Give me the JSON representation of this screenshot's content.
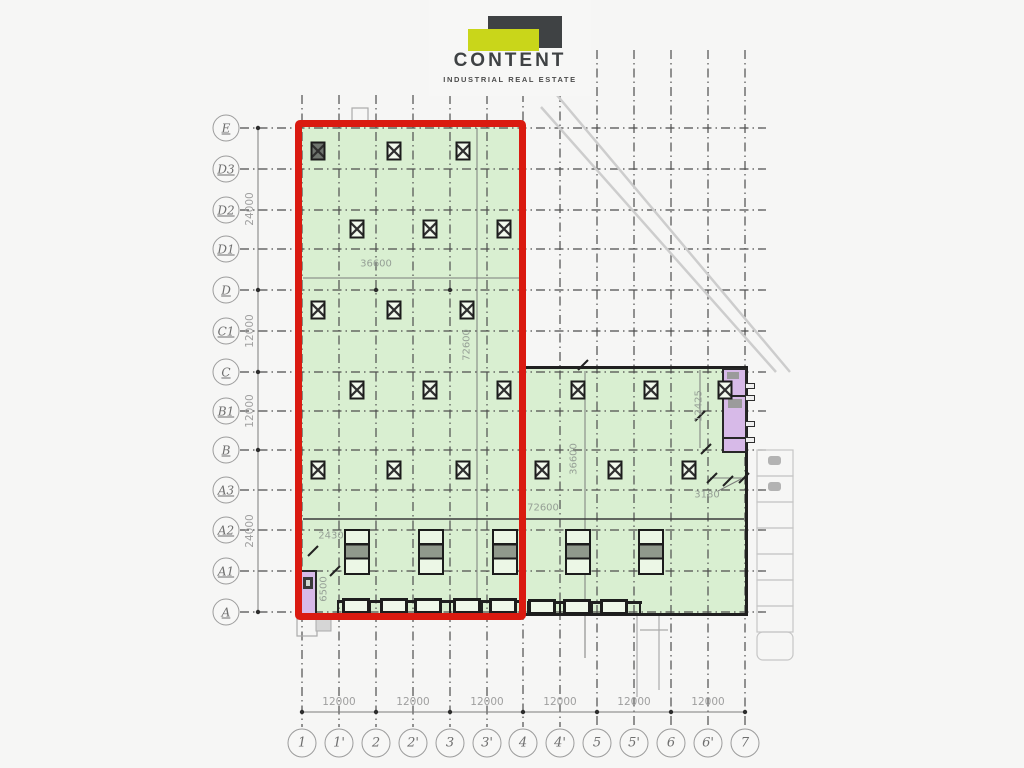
{
  "logo": {
    "title": "CONTENT",
    "subtitle": "INDUSTRIAL REAL ESTATE",
    "brand_dark": "#3f4244",
    "brand_accent": "#c9d61a"
  },
  "colors": {
    "highlight_red": "#da1a10",
    "area_green": "#d9efd1",
    "room_purple": "#d7bae8",
    "grid_line": "#4e4e4e",
    "dimension_text": "#96a096"
  },
  "axes": {
    "left": [
      {
        "label": "E",
        "x": 226,
        "y": 128
      },
      {
        "label": "D3",
        "x": 226,
        "y": 169
      },
      {
        "label": "D2",
        "x": 226,
        "y": 210
      },
      {
        "label": "D1",
        "x": 226,
        "y": 249
      },
      {
        "label": "D",
        "x": 226,
        "y": 290
      },
      {
        "label": "C1",
        "x": 226,
        "y": 331
      },
      {
        "label": "C",
        "x": 226,
        "y": 372
      },
      {
        "label": "B1",
        "x": 226,
        "y": 411
      },
      {
        "label": "B",
        "x": 226,
        "y": 450
      },
      {
        "label": "A3",
        "x": 226,
        "y": 490
      },
      {
        "label": "A2",
        "x": 226,
        "y": 530
      },
      {
        "label": "A1",
        "x": 226,
        "y": 571
      },
      {
        "label": "A",
        "x": 226,
        "y": 612
      }
    ],
    "bottom": [
      {
        "label": "1",
        "x": 302,
        "y": 743
      },
      {
        "label": "1'",
        "x": 339,
        "y": 743
      },
      {
        "label": "2",
        "x": 376,
        "y": 743
      },
      {
        "label": "2'",
        "x": 413,
        "y": 743
      },
      {
        "label": "3",
        "x": 450,
        "y": 743
      },
      {
        "label": "3'",
        "x": 487,
        "y": 743
      },
      {
        "label": "4",
        "x": 523,
        "y": 743
      },
      {
        "label": "4'",
        "x": 560,
        "y": 743
      },
      {
        "label": "5",
        "x": 597,
        "y": 743
      },
      {
        "label": "5'",
        "x": 634,
        "y": 743
      },
      {
        "label": "6",
        "x": 671,
        "y": 743
      },
      {
        "label": "6'",
        "x": 708,
        "y": 743
      },
      {
        "label": "7",
        "x": 745,
        "y": 743
      }
    ]
  },
  "dimensions": {
    "left": [
      {
        "label": "24000",
        "x": 250,
        "y": 209,
        "rot": -90
      },
      {
        "label": "12000",
        "x": 250,
        "y": 331,
        "rot": -90
      },
      {
        "label": "12000",
        "x": 250,
        "y": 411,
        "rot": -90
      },
      {
        "label": "24000",
        "x": 250,
        "y": 531,
        "rot": -90
      }
    ],
    "bottom": [
      {
        "label": "12000",
        "x": 339,
        "y": 702
      },
      {
        "label": "12000",
        "x": 413,
        "y": 702
      },
      {
        "label": "12000",
        "x": 487,
        "y": 702
      },
      {
        "label": "12000",
        "x": 560,
        "y": 702
      },
      {
        "label": "12000",
        "x": 634,
        "y": 702
      },
      {
        "label": "12000",
        "x": 708,
        "y": 702
      }
    ],
    "inplan": [
      {
        "label": "36600",
        "x": 376,
        "y": 264
      },
      {
        "label": "72600",
        "x": 467,
        "y": 345,
        "rot": -90
      },
      {
        "label": "72600",
        "x": 543,
        "y": 508
      },
      {
        "label": "36600",
        "x": 574,
        "y": 459,
        "rot": -90
      },
      {
        "label": "12425",
        "x": 699,
        "y": 406,
        "rot": -90
      },
      {
        "label": "3180",
        "x": 707,
        "y": 495
      },
      {
        "label": "2430",
        "x": 331,
        "y": 536
      },
      {
        "label": "6500",
        "x": 324,
        "y": 589,
        "rot": -90
      }
    ]
  },
  "plan": {
    "columns": [
      {
        "x": 318,
        "y": 151,
        "variant": "solid"
      },
      {
        "x": 394,
        "y": 151
      },
      {
        "x": 463,
        "y": 151
      },
      {
        "x": 357,
        "y": 229
      },
      {
        "x": 430,
        "y": 229
      },
      {
        "x": 504,
        "y": 229
      },
      {
        "x": 318,
        "y": 310
      },
      {
        "x": 394,
        "y": 310
      },
      {
        "x": 467,
        "y": 310
      },
      {
        "x": 357,
        "y": 390
      },
      {
        "x": 430,
        "y": 390
      },
      {
        "x": 504,
        "y": 390
      },
      {
        "x": 318,
        "y": 470
      },
      {
        "x": 394,
        "y": 470
      },
      {
        "x": 463,
        "y": 470
      },
      {
        "x": 578,
        "y": 390
      },
      {
        "x": 651,
        "y": 390
      },
      {
        "x": 725,
        "y": 390
      },
      {
        "x": 542,
        "y": 470
      },
      {
        "x": 615,
        "y": 470
      },
      {
        "x": 689,
        "y": 470
      }
    ],
    "dock_levelers": [
      {
        "x": 357,
        "y": 552
      },
      {
        "x": 431,
        "y": 552
      },
      {
        "x": 505,
        "y": 552
      },
      {
        "x": 578,
        "y": 552
      },
      {
        "x": 651,
        "y": 552
      }
    ],
    "dock_doors": [
      {
        "x": 356,
        "y": 606
      },
      {
        "x": 394,
        "y": 606
      },
      {
        "x": 428,
        "y": 606
      },
      {
        "x": 467,
        "y": 606
      },
      {
        "x": 503,
        "y": 606
      },
      {
        "x": 542,
        "y": 607
      },
      {
        "x": 577,
        "y": 607
      },
      {
        "x": 614,
        "y": 607
      }
    ],
    "door_handles": [
      {
        "x": 750,
        "y": 386
      },
      {
        "x": 750,
        "y": 398
      },
      {
        "x": 750,
        "y": 424
      },
      {
        "x": 750,
        "y": 440
      }
    ]
  }
}
